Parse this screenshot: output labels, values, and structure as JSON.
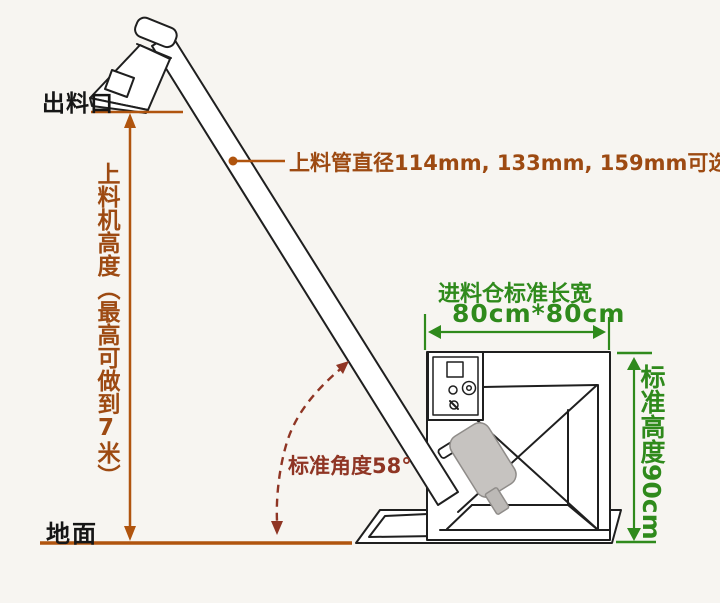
{
  "diagram": {
    "title_hint": "screw feeder dimension diagram",
    "background": "#f7f5f1",
    "colors": {
      "dimension_brown": "#b0540e",
      "text_brown": "#9d4a12",
      "annotation_green": "#2f8a1c",
      "angle_maroon": "#8f3524",
      "machine_line": "#1f1f1f",
      "motor_gray": "#c6c3c0"
    },
    "labels": {
      "outlet": "出料口",
      "ground": "地面",
      "feeder_height": {
        "part1": "上料机高度（最高可做到",
        "digit": "7",
        "part2": "米）"
      },
      "pipe_diameter": "上料管直径114mm, 133mm, 159mm可选",
      "bin_size_title": "进料仓标准长宽",
      "bin_size_value": "80cm*80cm",
      "standard_height": "标准高度90cm",
      "standard_angle": "标准角度58°"
    }
  }
}
